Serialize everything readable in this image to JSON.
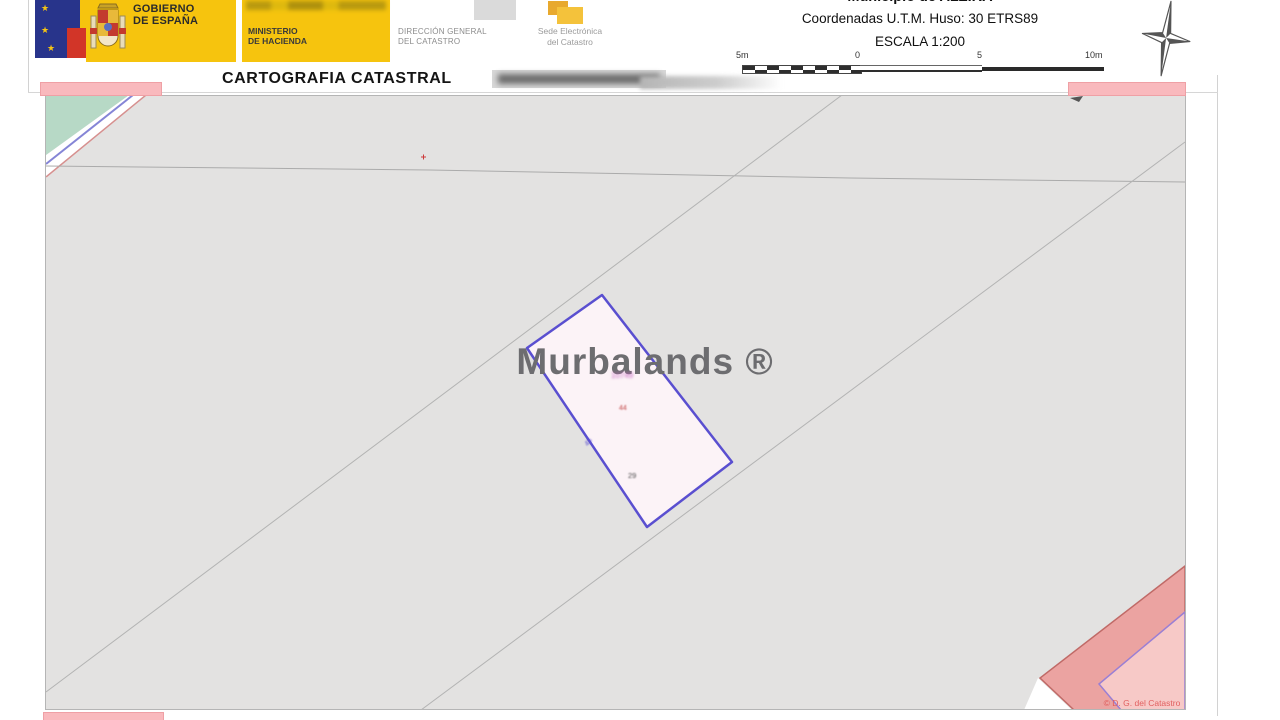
{
  "header": {
    "logo": {
      "gobierno_line1": "GOBIERNO",
      "gobierno_line2": "DE ESPAÑA",
      "ministerio_line1": "MINISTERIO",
      "ministerio_line2": "DE HACIENDA"
    },
    "direccion_line1": "DIRECCIÓN GENERAL",
    "direccion_line2": "DEL CATASTRO",
    "sede_line1": "Sede Electrónica",
    "sede_line2": "del Catastro",
    "title": "CARTOGRAFIA CATASTRAL",
    "municipio": "Municipio de ALZIRA",
    "coordenadas": "Coordenadas U.T.M. Huso: 30 ETRS89",
    "escala": "ESCALA 1:200",
    "scale_bar": {
      "labels": [
        "5m",
        "0",
        "5",
        "10m"
      ]
    }
  },
  "map": {
    "watermark": "Murbalands ®",
    "copyright": "© D. G. del Catastro",
    "parcel": {
      "number": "10749",
      "label_red": "44",
      "label_dark": "29",
      "edge_mark": "45"
    },
    "colors": {
      "brand_yellow": "#F6C40E",
      "map_background": "#E3E2E1",
      "parcel_outline": "#5A4FD0",
      "parcel_fill": "#FCF3F7",
      "green_area": "#B7D9C6",
      "redaction_pink": "#F9B9BD",
      "neighbor_parcel_pink": "#EBA3A1",
      "copyright_red": "#E05A5A"
    }
  }
}
